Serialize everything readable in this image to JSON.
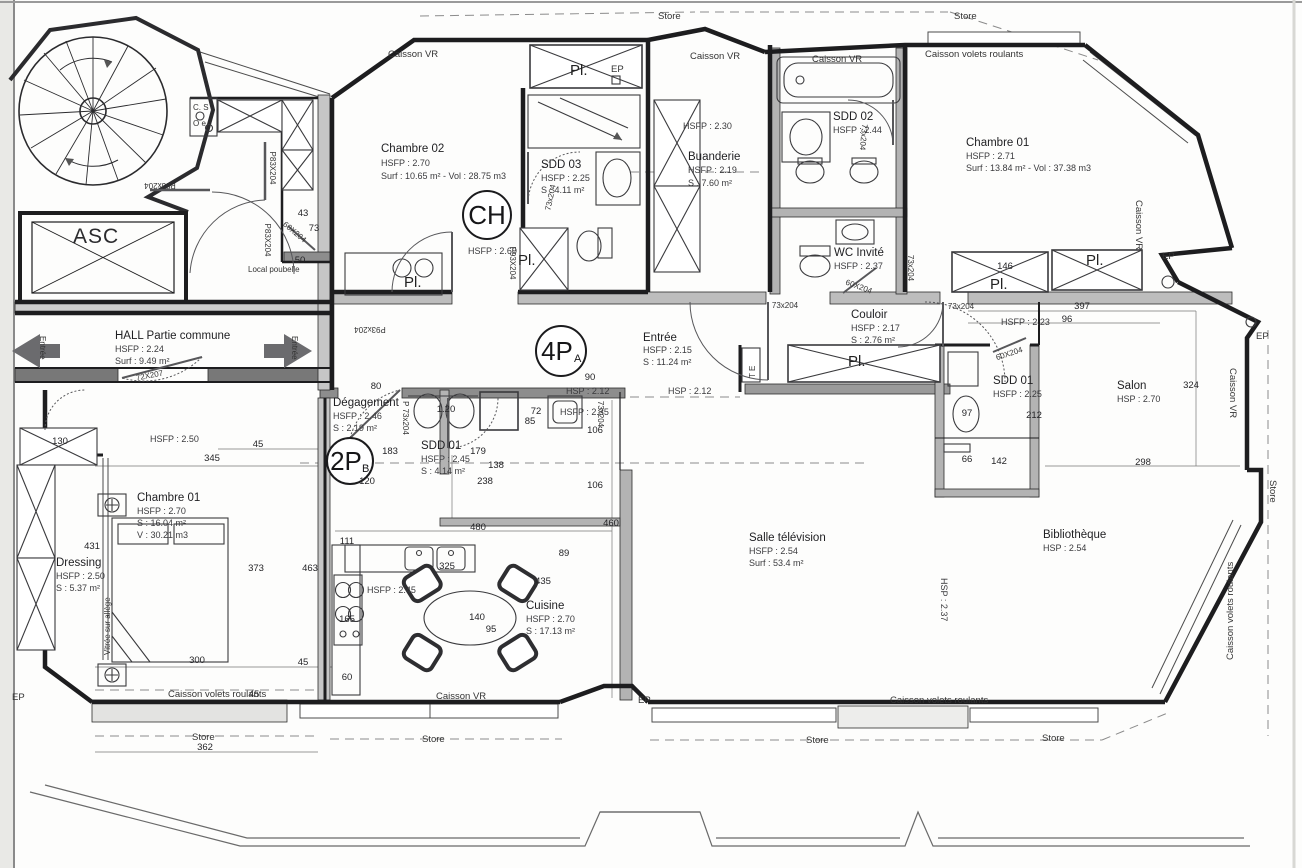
{
  "labels": {
    "store": "Store",
    "caisson_vr": "Caisson VR",
    "caisson_volets": "Caisson volets roulants",
    "ep": "EP",
    "asc": "ASC",
    "cs": "C. S",
    "oe": "O e",
    "local_poubelle": "Local poubelle",
    "entree": "Entrée",
    "vitree": "Vitrée sur allège",
    "te": "T E",
    "pl": "Pl."
  },
  "rooms": [
    {
      "name": "Chambre 02",
      "l1": "HSFP : 2.70",
      "l2": "Surf : 10.65 m² - Vol : 28.75 m3"
    },
    {
      "name": "SDD 03",
      "l1": "HSFP : 2.25",
      "l2": "S : 4.11 m²"
    },
    {
      "name": "Buanderie",
      "l1": "HSFP : 2.19",
      "l2": "S : 7.60 m²"
    },
    {
      "name": "SDD 02",
      "l1": "HSFP : 2.44"
    },
    {
      "name": "Chambre 01",
      "l1": "HSFP : 2.71",
      "l2": "Surf : 13.84 m² - Vol : 37.38 m3"
    },
    {
      "name": "WC Invité",
      "l1": "HSFP : 2.37"
    },
    {
      "name": "Couloir",
      "l1": "HSFP : 2.17",
      "l2": "S : 2.76 m²"
    },
    {
      "name": "HALL Partie commune",
      "l1": "HSFP : 2.24",
      "l2": "Surf : 9.49 m²"
    },
    {
      "name": "Entrée",
      "l1": "HSFP : 2.15",
      "l2": "S : 11.24 m²"
    },
    {
      "name": "Dégagement",
      "l1": "HSFP : 2.46",
      "l2": "S : 2.19 m²"
    },
    {
      "name": "SDD 01",
      "l1": "HSFP : 2.45",
      "l2": "S : 4.14 m²"
    },
    {
      "name": "Chambre 01",
      "l1": "HSFP : 2.70",
      "l2": "S : 16.04 m²",
      "l3": "V : 30.21 m3"
    },
    {
      "name": "Dressing",
      "l1": "HSFP : 2.50",
      "l2": "S : 5.37 m²"
    },
    {
      "name": "Cuisine",
      "l1": "HSFP : 2.70",
      "l2": "S : 17.13 m²"
    },
    {
      "name": "Salle télévision",
      "l1": "HSFP : 2.54",
      "l2": "Surf : 53.4 m²"
    },
    {
      "name": "Bibliothèque",
      "l1": "HSP : 2.54"
    },
    {
      "name": "Salon",
      "l1": "HSP : 2.70"
    },
    {
      "name": "SDD 01",
      "l1": "HSFP : 2.25"
    }
  ],
  "badges": [
    {
      "t": "CH",
      "s": ""
    },
    {
      "t": "4P",
      "s": "A"
    },
    {
      "t": "2P",
      "s": "B"
    }
  ],
  "heights": [
    "HSFP : 2.60",
    "HSFP : 2.50",
    "HSP : 2.12",
    "HSFP : 2.35",
    "HSP : 2.12",
    "HSFP : 2.30",
    "HSFP : 2.23",
    "HSFP : 2.45",
    "HSP : 2.37"
  ],
  "dims": [
    "43",
    "73",
    "50",
    "80",
    "90",
    "130",
    "45",
    "345",
    "431",
    "373",
    "463",
    "300",
    "45",
    "45",
    "362",
    "111",
    "183",
    "120",
    "179",
    "138",
    "238",
    "1.20",
    "72",
    "85",
    "106",
    "106",
    "480",
    "460",
    "89",
    "325",
    "435",
    "140",
    "95",
    "165",
    "60",
    "146",
    "397",
    "96",
    "97",
    "212",
    "66",
    "142",
    "298",
    "324"
  ],
  "doors": [
    "P83x204",
    "P83X204",
    "P83X204",
    "60X204",
    "72X207",
    "P93x204",
    "73x204",
    "P93X204",
    "73x204",
    "60X204",
    "73x204",
    "73x204",
    "P 73x204",
    "73x204",
    "73x204",
    "60X204"
  ]
}
